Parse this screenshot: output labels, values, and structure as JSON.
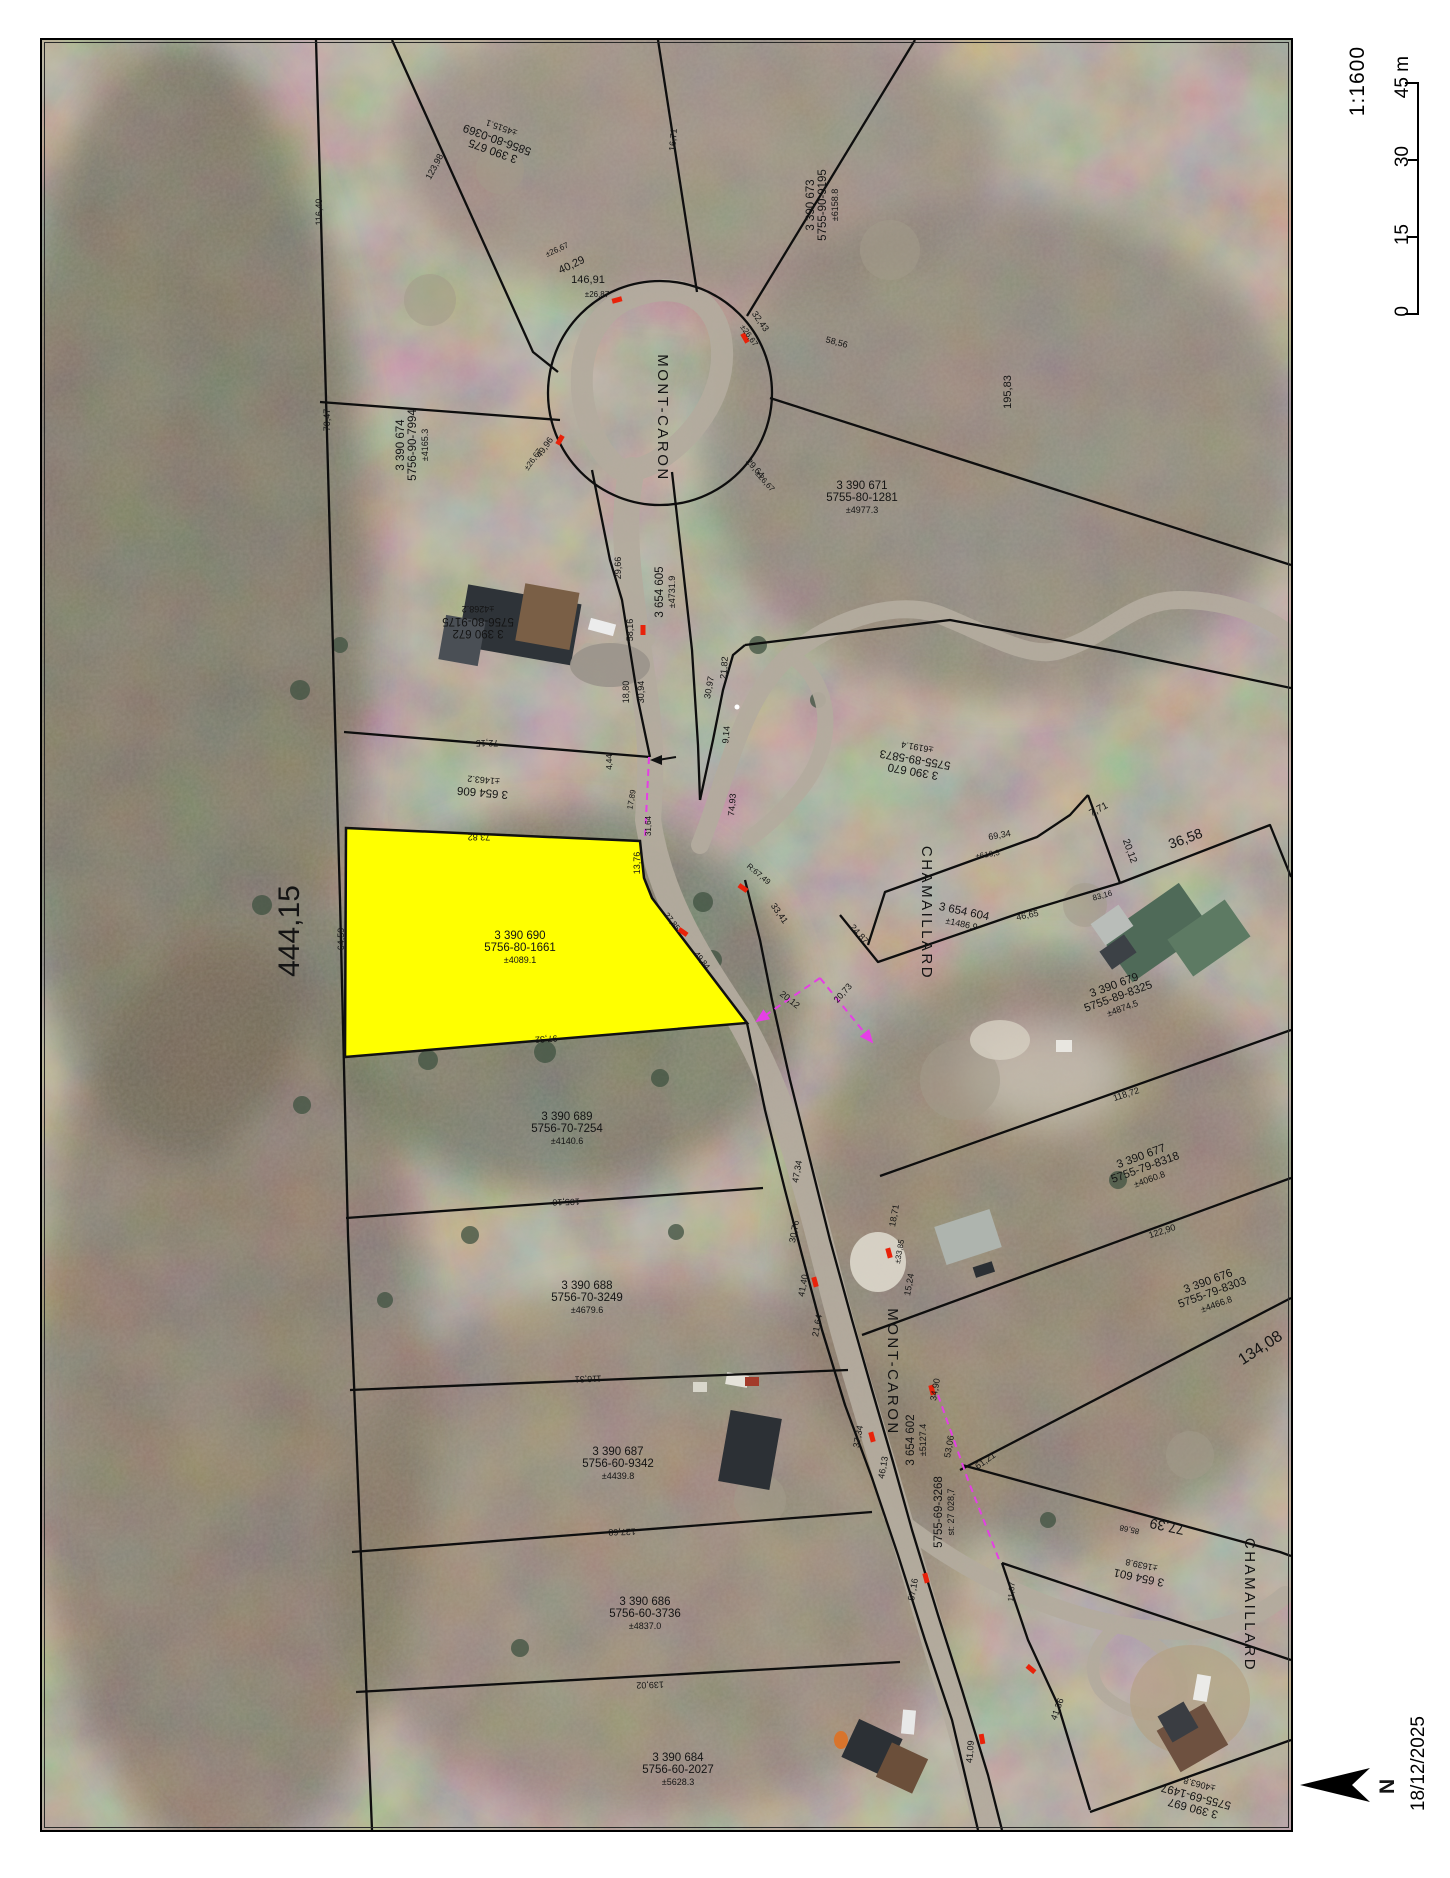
{
  "scalebar": {
    "ratio": "1:1600",
    "ticks": [
      "0",
      "15",
      "30",
      "45 m"
    ]
  },
  "footer": {
    "date": "18/12/2025",
    "north": "N"
  },
  "colors": {
    "highlight": "#ffff00",
    "marker_red": "#e8220a",
    "survey_pink": "#e53fe5",
    "boundary": "#0e0e0e"
  },
  "map": {
    "street_labels": [
      {
        "t": "MONT-CARON",
        "x": 658,
        "y": 418,
        "r": 90
      },
      {
        "t": "MONT-CARON",
        "x": 888,
        "y": 1372,
        "r": 90
      },
      {
        "t": "CHAMAILLARD",
        "x": 922,
        "y": 913,
        "r": 90
      },
      {
        "t": "CHAMAILLARD",
        "x": 1245,
        "y": 1605,
        "r": 90
      }
    ],
    "parcel_labels": [
      {
        "lines": [
          "3 390 674",
          "5756-90-7994",
          "±4165.3"
        ],
        "x": 412,
        "y": 445,
        "r": -90
      },
      {
        "lines": [
          "3 390 675",
          "5856-80-0369",
          "±4515.1"
        ],
        "x": 497,
        "y": 140,
        "r": 200
      },
      {
        "lines": [
          "3 390 673",
          "5755-90-9195",
          "±6158.8"
        ],
        "x": 822,
        "y": 205,
        "r": -90
      },
      {
        "lines": [
          "3 390 671",
          "5755-80-1281",
          "±4977.3"
        ],
        "x": 862,
        "y": 497,
        "r": 0
      },
      {
        "lines": [
          "3 390 672",
          "5756-80-9175",
          "±4268.2"
        ],
        "x": 478,
        "y": 622,
        "r": 180
      },
      {
        "lines": [
          "3 654 605",
          "±4731.9"
        ],
        "x": 665,
        "y": 592,
        "r": -90
      },
      {
        "lines": [
          "3 654 606",
          "±1463.2"
        ],
        "x": 483,
        "y": 787,
        "r": 185
      },
      {
        "lines": [
          "3 390 670",
          "5755-89-5873",
          "±6191.4"
        ],
        "x": 915,
        "y": 760,
        "r": 190
      },
      {
        "lines": [
          "3 654 604",
          "±1486.9"
        ],
        "x": 963,
        "y": 917,
        "r": 12
      },
      {
        "lines": [
          "3 390 690",
          "5756-80-1661",
          "±4089.1"
        ],
        "x": 520,
        "y": 947,
        "r": 0
      },
      {
        "lines": [
          "3 390 679",
          "5755-89-8325",
          "±4874.5"
        ],
        "x": 1118,
        "y": 996,
        "r": -20
      },
      {
        "lines": [
          "3 390 677",
          "5755-79-8318",
          "±4060.8"
        ],
        "x": 1145,
        "y": 1167,
        "r": -20
      },
      {
        "lines": [
          "3 390 676",
          "5755-79-8303",
          "±4466.8"
        ],
        "x": 1212,
        "y": 1292,
        "r": -20
      },
      {
        "lines": [
          "3 390 689",
          "5756-70-7254",
          "±4140.6"
        ],
        "x": 567,
        "y": 1128,
        "r": 0
      },
      {
        "lines": [
          "3 390 688",
          "5756-70-3249",
          "±4679.6"
        ],
        "x": 587,
        "y": 1297,
        "r": 0
      },
      {
        "lines": [
          "3 390 687",
          "5756-60-9342",
          "±4439.8"
        ],
        "x": 618,
        "y": 1463,
        "r": 0
      },
      {
        "lines": [
          "3 390 686",
          "5756-60-3736",
          "±4837.0"
        ],
        "x": 645,
        "y": 1613,
        "r": 0
      },
      {
        "lines": [
          "3 390 684",
          "5756-60-2027",
          "±5628.3"
        ],
        "x": 678,
        "y": 1769,
        "r": 0
      },
      {
        "lines": [
          "3 654 602",
          "±5127.4"
        ],
        "x": 916,
        "y": 1440,
        "r": -90
      },
      {
        "lines": [
          "5755-69-3268",
          "st: 27 028,7"
        ],
        "x": 944,
        "y": 1512,
        "r": -90
      },
      {
        "lines": [
          "3 654 601",
          "±1639.8"
        ],
        "x": 1140,
        "y": 1572,
        "r": 192
      },
      {
        "lines": [
          "3 390 697",
          "5755-69-1497",
          "±4063.8"
        ],
        "x": 1196,
        "y": 1797,
        "r": 195
      }
    ],
    "edge_labels": [
      {
        "t": "116,40",
        "x": 322,
        "y": 212,
        "r": -90
      },
      {
        "t": "123,98",
        "x": 437,
        "y": 168,
        "r": -62
      },
      {
        "t": "16,71",
        "x": 676,
        "y": 140,
        "r": -85
      },
      {
        "t": "70,47",
        "x": 330,
        "y": 420,
        "r": -90
      },
      {
        "t": "146,91",
        "x": 588,
        "y": 283,
        "r": 0,
        "fs": 11
      },
      {
        "t": "±26,87",
        "x": 597,
        "y": 297,
        "r": 0,
        "fs": 8
      },
      {
        "t": "40,29",
        "x": 573,
        "y": 268,
        "r": -25,
        "fs": 11
      },
      {
        "t": "±26,67",
        "x": 558,
        "y": 252,
        "r": -25,
        "fs": 8
      },
      {
        "t": "32,43",
        "x": 758,
        "y": 323,
        "r": 55
      },
      {
        "t": "±26,67",
        "x": 747,
        "y": 337,
        "r": 55,
        "fs": 8
      },
      {
        "t": "49,96",
        "x": 547,
        "y": 449,
        "r": -55
      },
      {
        "t": "±26,67",
        "x": 535,
        "y": 461,
        "r": -55,
        "fs": 8
      },
      {
        "t": "29,64",
        "x": 753,
        "y": 470,
        "r": 48
      },
      {
        "t": "±26,67",
        "x": 763,
        "y": 483,
        "r": 48,
        "fs": 8
      },
      {
        "t": "58,56",
        "x": 836,
        "y": 345,
        "r": 15
      },
      {
        "t": "195,83",
        "x": 1011,
        "y": 392,
        "r": -90,
        "fs": 11
      },
      {
        "t": "29,66",
        "x": 621,
        "y": 568,
        "r": -90
      },
      {
        "t": "58,16",
        "x": 633,
        "y": 630,
        "r": -90
      },
      {
        "t": "18,80",
        "x": 629,
        "y": 692,
        "r": -90
      },
      {
        "t": "30,94",
        "x": 644,
        "y": 692,
        "r": -90
      },
      {
        "t": "30,97",
        "x": 712,
        "y": 688,
        "r": -80
      },
      {
        "t": "21,82",
        "x": 727,
        "y": 668,
        "r": -85
      },
      {
        "t": "9,14",
        "x": 729,
        "y": 735,
        "r": -85
      },
      {
        "t": "74,93",
        "x": 735,
        "y": 805,
        "r": -85
      },
      {
        "t": "72,15",
        "x": 487,
        "y": 740,
        "r": 180
      },
      {
        "t": "4,44",
        "x": 612,
        "y": 762,
        "r": -90,
        "fs": 8
      },
      {
        "t": "17,89",
        "x": 634,
        "y": 800,
        "r": -80,
        "fs": 8
      },
      {
        "t": "31,64",
        "x": 651,
        "y": 826,
        "r": -90,
        "fs": 8
      },
      {
        "t": "13,76",
        "x": 640,
        "y": 863,
        "r": -90
      },
      {
        "t": "73,82",
        "x": 479,
        "y": 834,
        "r": 180
      },
      {
        "t": "64,59",
        "x": 344,
        "y": 939,
        "r": -90
      },
      {
        "t": "27,85",
        "x": 670,
        "y": 923,
        "r": 52,
        "fs": 8
      },
      {
        "t": "49,84",
        "x": 700,
        "y": 962,
        "r": 52,
        "fs": 8
      },
      {
        "t": "97,32",
        "x": 546,
        "y": 1036,
        "r": 176
      },
      {
        "t": "R:67,49",
        "x": 757,
        "y": 876,
        "r": 40,
        "fs": 8
      },
      {
        "t": "33,41",
        "x": 777,
        "y": 915,
        "r": 55
      },
      {
        "t": "24,87",
        "x": 857,
        "y": 936,
        "r": 48
      },
      {
        "t": "20,12",
        "x": 788,
        "y": 1002,
        "r": 38
      },
      {
        "t": "20,73",
        "x": 845,
        "y": 995,
        "r": -48
      },
      {
        "t": "69,34",
        "x": 1000,
        "y": 838,
        "r": -10
      },
      {
        "t": "±616,3",
        "x": 988,
        "y": 857,
        "r": -10,
        "fs": 8
      },
      {
        "t": "46,65",
        "x": 1028,
        "y": 918,
        "r": -12
      },
      {
        "t": "7,71",
        "x": 1100,
        "y": 812,
        "r": -28,
        "fs": 10
      },
      {
        "t": "20,12",
        "x": 1127,
        "y": 852,
        "r": 70,
        "fs": 10
      },
      {
        "t": "36,58",
        "x": 1187,
        "y": 843,
        "r": -20,
        "fs": 14
      },
      {
        "t": "83,16",
        "x": 1103,
        "y": 898,
        "r": -15,
        "fs": 8
      },
      {
        "t": "118,72",
        "x": 1127,
        "y": 1097,
        "r": -18
      },
      {
        "t": "122,90",
        "x": 1163,
        "y": 1234,
        "r": -18
      },
      {
        "t": "134,08",
        "x": 1263,
        "y": 1352,
        "r": -33,
        "fs": 16
      },
      {
        "t": "105,10",
        "x": 566,
        "y": 1199,
        "r": 178
      },
      {
        "t": "116,31",
        "x": 588,
        "y": 1376,
        "r": 178
      },
      {
        "t": "127,68",
        "x": 622,
        "y": 1529,
        "r": 178
      },
      {
        "t": "139,02",
        "x": 650,
        "y": 1682,
        "r": 178
      },
      {
        "t": "47,34",
        "x": 800,
        "y": 1172,
        "r": -80
      },
      {
        "t": "30,76",
        "x": 797,
        "y": 1232,
        "r": -80
      },
      {
        "t": "41,40",
        "x": 806,
        "y": 1286,
        "r": -80
      },
      {
        "t": "21,64",
        "x": 820,
        "y": 1326,
        "r": -80
      },
      {
        "t": "37,34",
        "x": 861,
        "y": 1437,
        "r": -80
      },
      {
        "t": "46,13",
        "x": 886,
        "y": 1468,
        "r": -80
      },
      {
        "t": "57,16",
        "x": 916,
        "y": 1590,
        "r": -80
      },
      {
        "t": "18,71",
        "x": 897,
        "y": 1216,
        "r": -80
      },
      {
        "t": "±33,85",
        "x": 902,
        "y": 1252,
        "r": -80,
        "fs": 8
      },
      {
        "t": "15,24",
        "x": 912,
        "y": 1285,
        "r": -80
      },
      {
        "t": "34,90",
        "x": 938,
        "y": 1390,
        "r": -80
      },
      {
        "t": "53,06",
        "x": 952,
        "y": 1447,
        "r": -80
      },
      {
        "t": "61,21",
        "x": 987,
        "y": 1463,
        "r": -35
      },
      {
        "t": "77,39",
        "x": 1168,
        "y": 1522,
        "r": 192,
        "fs": 14
      },
      {
        "t": "85,68",
        "x": 1130,
        "y": 1527,
        "r": 192,
        "fs": 8
      },
      {
        "t": "11,07",
        "x": 1014,
        "y": 1592,
        "r": -85,
        "fs": 8
      },
      {
        "t": "41,36",
        "x": 1060,
        "y": 1710,
        "r": -70
      },
      {
        "t": "41,09",
        "x": 973,
        "y": 1752,
        "r": -85
      },
      {
        "t": "444,15",
        "x": 299,
        "y": 931,
        "r": -90,
        "fs": 30
      }
    ],
    "red_marks": [
      {
        "x": 617,
        "y": 300,
        "r": -15
      },
      {
        "x": 745,
        "y": 338,
        "r": 60
      },
      {
        "x": 560,
        "y": 440,
        "r": -60
      },
      {
        "x": 643,
        "y": 630,
        "r": 90
      },
      {
        "x": 683,
        "y": 932,
        "r": 35
      },
      {
        "x": 743,
        "y": 888,
        "r": 35
      },
      {
        "x": 815,
        "y": 1282,
        "r": 75
      },
      {
        "x": 889,
        "y": 1253,
        "r": 75
      },
      {
        "x": 932,
        "y": 1390,
        "r": 75
      },
      {
        "x": 872,
        "y": 1437,
        "r": 75
      },
      {
        "x": 926,
        "y": 1578,
        "r": 75
      },
      {
        "x": 1031,
        "y": 1669,
        "r": 40
      },
      {
        "x": 982,
        "y": 1739,
        "r": 80
      }
    ]
  }
}
